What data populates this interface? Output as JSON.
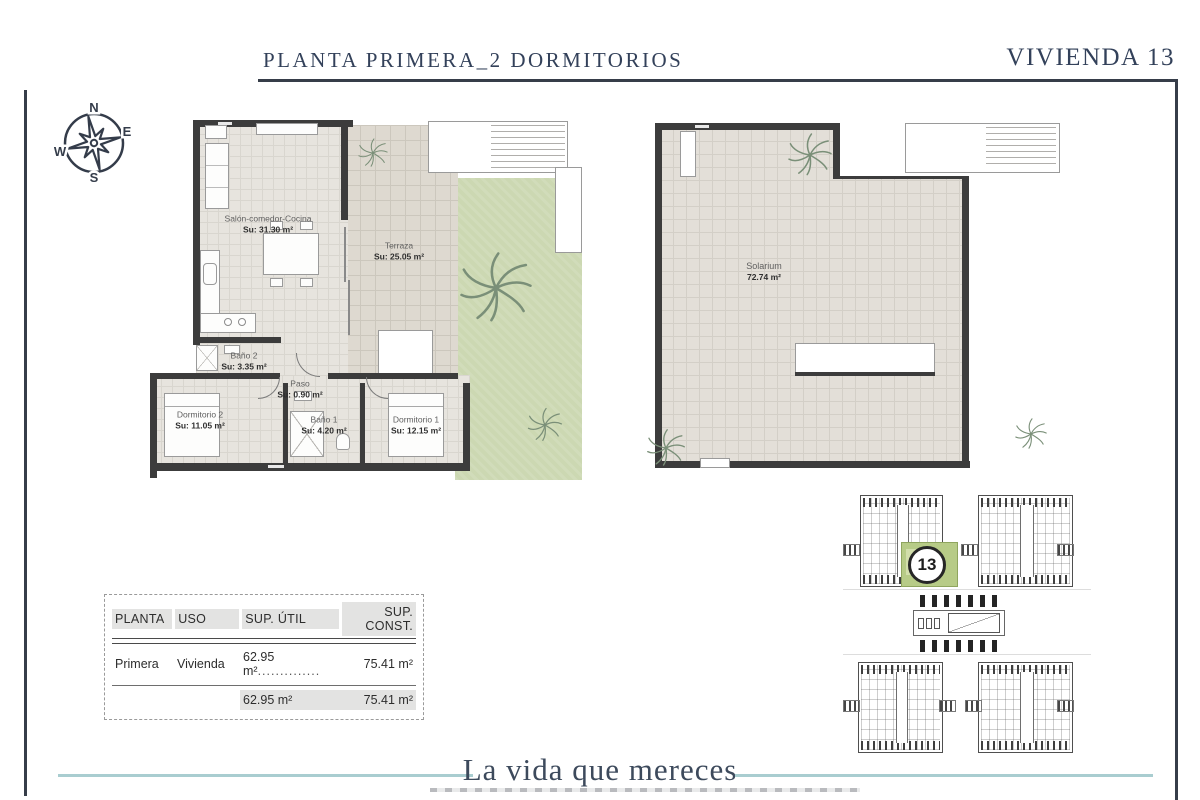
{
  "header": {
    "title": "PLANTA PRIMERA_2 DORMITORIOS",
    "unit": "VIVIENDA 13"
  },
  "compass": {
    "n": "N",
    "e": "E",
    "s": "S",
    "w": "W"
  },
  "floorplan": {
    "rooms": [
      {
        "name": "Salón-comedor-Cocina",
        "area": "Su: 31.30 m²"
      },
      {
        "name": "Terraza",
        "area": "Su: 25.05 m²"
      },
      {
        "name": "Baño 2",
        "area": "Su: 3.35 m²"
      },
      {
        "name": "Paso",
        "area": "Su: 0.90 m²"
      },
      {
        "name": "Dormitorio 2",
        "area": "Su: 11.05 m²"
      },
      {
        "name": "Baño 1",
        "area": "Su: 4.20 m²"
      },
      {
        "name": "Dormitorio 1",
        "area": "Su: 12.15 m²"
      }
    ]
  },
  "solarium": {
    "name": "Solarium",
    "area": "72.74 m²"
  },
  "site_plan": {
    "unit_number": "13"
  },
  "table": {
    "headers": [
      "PLANTA",
      "USO",
      "SUP. ÚTIL",
      "SUP. CONST."
    ],
    "row": {
      "planta": "Primera",
      "uso": "Vivienda",
      "sup_util": "62.95 m²",
      "leader": "..............",
      "sup_const": "75.41 m²"
    },
    "totals": {
      "sup_util": "62.95 m²",
      "sup_const": "75.41 m²"
    }
  },
  "footer": {
    "tagline": "La vida que mereces"
  },
  "colors": {
    "accent_dark": "#33415a",
    "teal": "#a9cdd0",
    "garden_green": "#ccd8b2",
    "highlight_green": "#b7cb87"
  }
}
